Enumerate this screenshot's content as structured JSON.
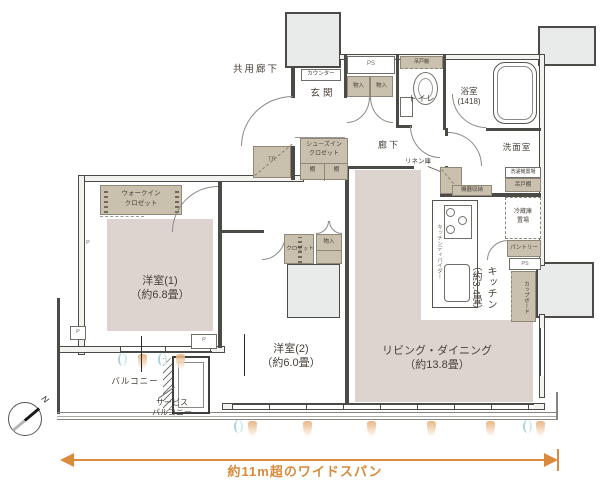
{
  "colors": {
    "accent_orange": "#D98A3C",
    "storage_beige": "#C9C0AE",
    "room_pink": "#DDD4D0",
    "column_gray": "#E9EBEA",
    "wall_dark": "#4A4A47",
    "vent_orange": "#E5A870",
    "vent_blue": "#9ED0DA"
  },
  "rooms": {
    "common_corridor": "共用廊下",
    "entrance": "玄関",
    "corridor": "廊下",
    "toilet": "トイレ",
    "bathroom": "浴室",
    "bathroom_size": "(1418)",
    "washroom": "洗面室",
    "bedroom1": "洋室(1)",
    "bedroom1_size": "（約6.8畳）",
    "bedroom2": "洋室(2)",
    "bedroom2_size": "（約6.0畳）",
    "living_dining": "リビング・ダイニング",
    "living_dining_size": "（約13.8畳）",
    "kitchen": "キッチン",
    "kitchen_size": "（約3.4畳）",
    "balcony": "バルコニー",
    "service_balcony_l1": "サービス",
    "service_balcony_l2": "バルコニー"
  },
  "fixtures": {
    "counter": "カウンター",
    "ps": "PS",
    "storage": "物入",
    "hanging_cupboard": "吊戸棚",
    "shoes_closet_l1": "シューズイン",
    "walk_in_closet_l1": "ウォークイン",
    "closet": "クロゼット",
    "shelf": "棚",
    "trunk_room": "TR",
    "linen_storage": "リネン庫",
    "equipment_storage": "機器収納",
    "washer_space": "洗濯機置場",
    "fridge_l1": "冷蔵庫",
    "fridge_l2": "置場",
    "pantry": "パントリー",
    "cupboard": "カップボード",
    "kitchen_divider": "キッチンディバイダー",
    "pillar": "P"
  },
  "annotations": {
    "wide_span": "約11m超のワイドスパン",
    "north": "N"
  }
}
